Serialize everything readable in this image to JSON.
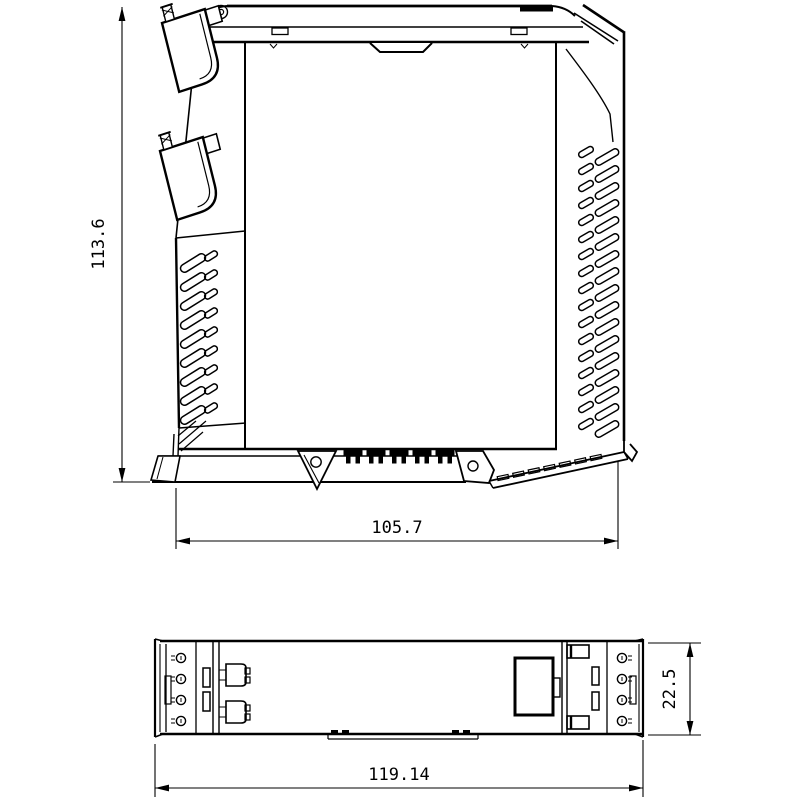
{
  "colors": {
    "line": "#000000",
    "background": "#ffffff"
  },
  "views": {
    "front": {
      "dim_height": "113.6",
      "dim_width": "105.7"
    },
    "bottom": {
      "dim_depth": "22.5",
      "dim_width": "119.14"
    }
  }
}
